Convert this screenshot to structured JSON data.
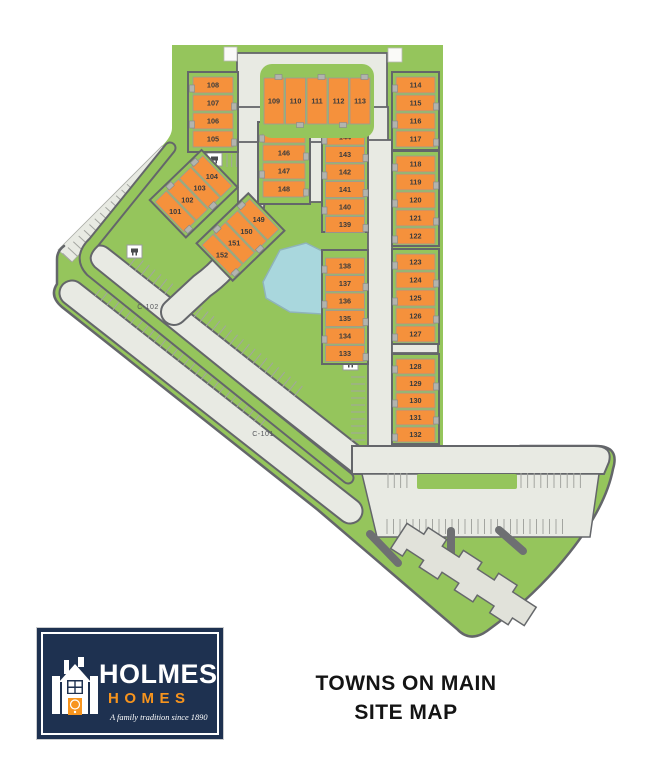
{
  "site": {
    "name": "Towns on Main site plan",
    "title_lines": [
      "TOWNS ON MAIN",
      "SITE MAP"
    ],
    "roads": [
      {
        "id": "c102",
        "label": "C-102"
      },
      {
        "id": "c101",
        "label": "C-101"
      }
    ],
    "blocks": [
      {
        "id": "b1",
        "units": [
          "108",
          "107",
          "106",
          "105"
        ]
      },
      {
        "id": "b2",
        "units": [
          "109",
          "110",
          "111",
          "112",
          "113"
        ]
      },
      {
        "id": "b3",
        "units": [
          "114",
          "115",
          "116",
          "117"
        ]
      },
      {
        "id": "b4",
        "units": [
          "145",
          "146",
          "147",
          "148"
        ]
      },
      {
        "id": "b5",
        "units": [
          "144",
          "143",
          "142",
          "141",
          "140",
          "139"
        ]
      },
      {
        "id": "b6",
        "units": [
          "118",
          "119",
          "120",
          "121",
          "122"
        ]
      },
      {
        "id": "b7",
        "units": [
          "138",
          "137",
          "136",
          "135",
          "134",
          "133"
        ]
      },
      {
        "id": "b8",
        "units": [
          "123",
          "124",
          "125",
          "126",
          "127"
        ]
      },
      {
        "id": "b9",
        "units": [
          "128",
          "129",
          "130",
          "131",
          "132"
        ]
      },
      {
        "id": "d1",
        "units": [
          "104",
          "103",
          "102",
          "101"
        ]
      },
      {
        "id": "d2",
        "units": [
          "149",
          "150",
          "151",
          "152"
        ]
      }
    ],
    "features": [
      "pond",
      "parking-lot",
      "apartment-building",
      "mailbox-kiosks"
    ],
    "colors": {
      "green": "#95c55c",
      "road": "#e8eae3",
      "road_edge": "#64666a",
      "unit_orange": "#f5913c",
      "unit_tab": "#b2b4ae",
      "pond": "#a9d7dd",
      "pond_edge": "#8fb3ba",
      "building": "#e1e2da",
      "hatch": "#a3a5a0",
      "logo_navy": "#1e3150",
      "logo_orange": "#f7941d"
    },
    "logo": {
      "brand": "HOLMES",
      "brand2": "HOMES",
      "tagline": "A family tradition since 1890"
    }
  }
}
